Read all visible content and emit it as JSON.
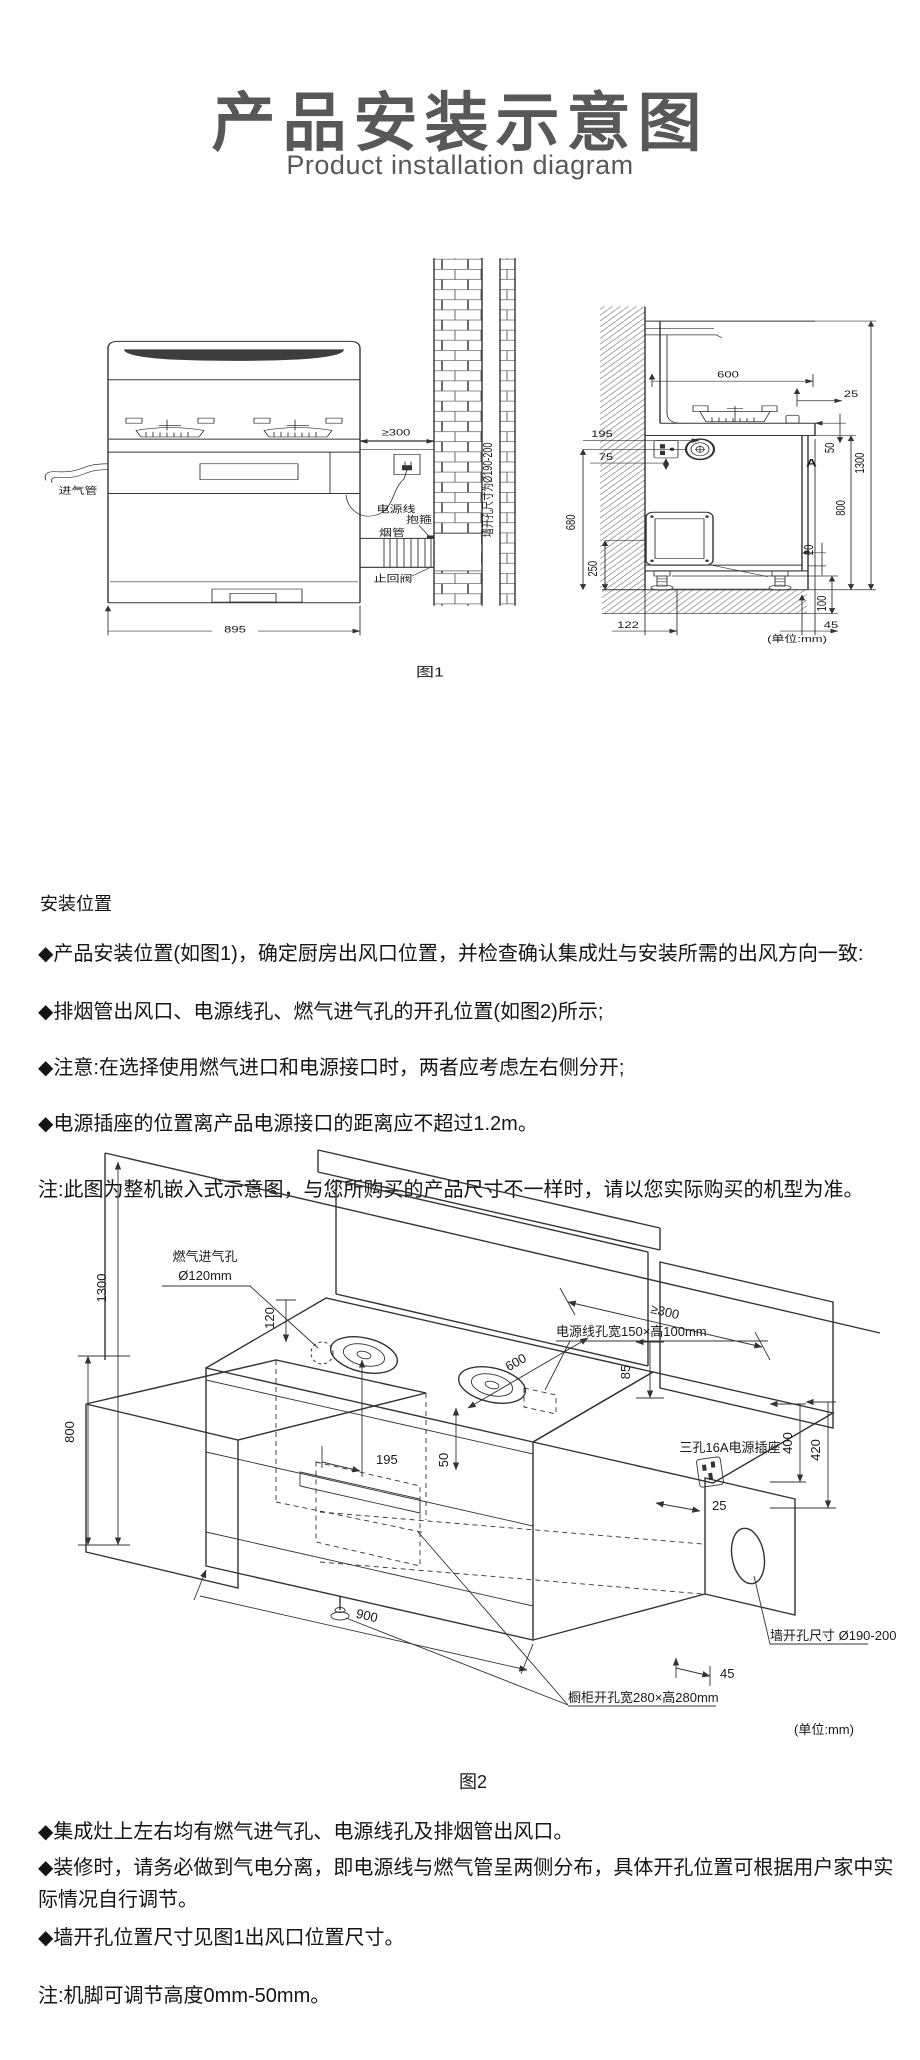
{
  "header": {
    "title": "产品安装示意图",
    "subtitle": "Product installation diagram"
  },
  "f1": {
    "caption": "图1",
    "unit": "(单位:mm)",
    "front": {
      "gas_inlet": "进气管",
      "power_cord": "电源线",
      "clamp": "抱箍",
      "smoke_pipe": "烟管",
      "check_valve": "止回阀",
      "wall_hole": "墙开孔尺寸为Ø190-200",
      "gap_wall": "≥300",
      "width": "895"
    },
    "side": {
      "d600": "600",
      "d25": "25",
      "d195": "195",
      "d75": "75",
      "d680": "680",
      "d250": "250",
      "d50": "50",
      "d800": "800",
      "d1300": "1300",
      "d20": "20",
      "d100": "100",
      "d122": "122",
      "d45": "45",
      "mark": "A"
    }
  },
  "install": {
    "heading": "安装位置",
    "bullets": [
      "◆产品安装位置(如图1)，确定厨房出风口位置，并检查确认集成灶与安装所需的出风方向一致:",
      "◆排烟管出风口、电源线孔、燃气进气孔的开孔位置(如图2)所示;",
      "◆注意:在选择使用燃气进口和电源接口时，两者应考虑左右侧分开;",
      "◆电源插座的位置离产品电源接口的距离应不超过1.2m。"
    ],
    "note": "注:此图为整机嵌入式示意图，与您所购买的产品尺寸不一样时，请以您实际购买的机型为准。"
  },
  "f2": {
    "caption": "图2",
    "unit": "(单位:mm)",
    "labels": {
      "gas_hole_1": "燃气进气孔",
      "gas_hole_2": "Ø120mm",
      "power_hole": "电源线孔宽150×高100mm",
      "socket": "三孔16A电源插座",
      "wall_hole": "墙开孔尺寸 Ø190-200",
      "cabinet_hole": "橱柜开孔宽280×高280mm"
    },
    "dims": {
      "d1300": "1300",
      "d800": "800",
      "d120": "120",
      "d195": "195",
      "d50": "50",
      "d600": "600",
      "d300": "≥300",
      "d85": "85",
      "d400": "400",
      "d420": "420",
      "d25": "25",
      "d900": "900",
      "d45": "45"
    }
  },
  "notes": {
    "bullets": [
      "◆集成灶上左右均有燃气进气孔、电源线孔及排烟管出风口。",
      "◆装修时，请务必做到气电分离，即电源线与燃气管呈两侧分布，具体开孔位置可根据用户家中实际情况自行调节。",
      "◆墙开孔位置尺寸见图1出风口位置尺寸。"
    ],
    "note": "注:机脚可调节高度0mm-50mm。"
  }
}
